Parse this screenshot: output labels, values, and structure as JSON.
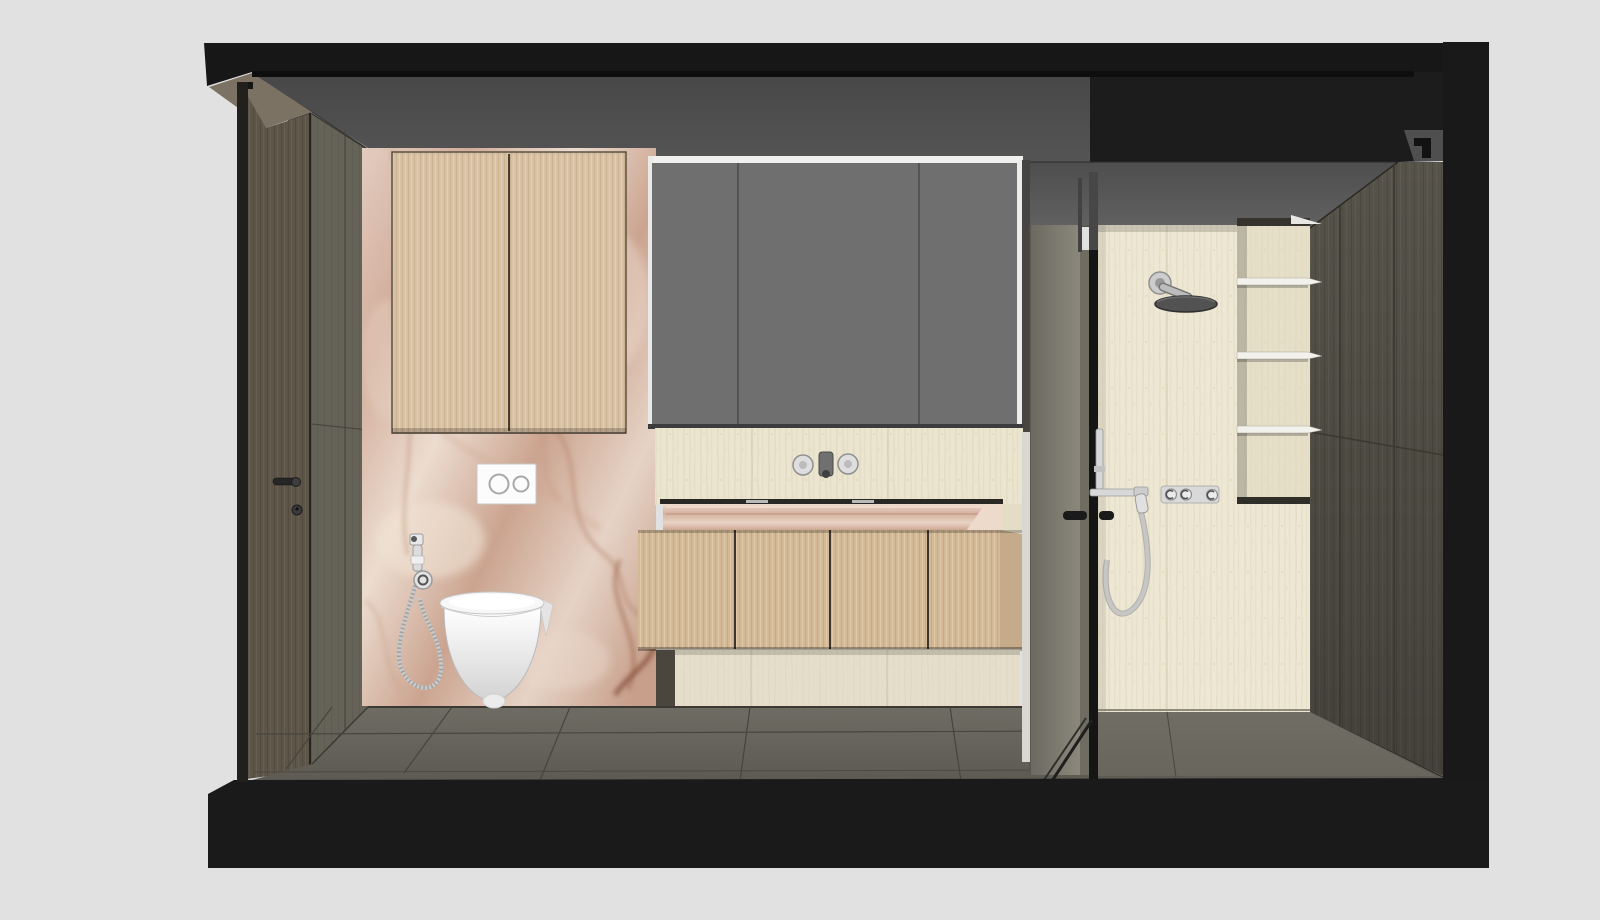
{
  "scene": {
    "description": "3D cutaway section render of a modern bathroom interior, flat-shaded CAD style, no visible text or UI chrome",
    "view": "front section perspective looking into the room",
    "background_color": "#e1e1e1"
  },
  "palette": {
    "background": "#e1e1e1",
    "frame-black": "#171717",
    "soffit-black": "#1c1c1c",
    "ceiling-gray": "#525252",
    "mirror-gray": "#6f6f6f",
    "trim-white": "#f0f0ef",
    "door-brown": "#5e5549",
    "side-wall": "#656258",
    "onyx-base": "#d9bcab",
    "onyx-vein": "#a6755c",
    "wood-light": "#d7c2a5",
    "wood-drawer": "#d3b996",
    "travertine": "#ebe4cf",
    "travertine-shower": "#ede7d3",
    "plinth": "#e5decb",
    "counter-onyx": "#ddbda9",
    "floor-gray": "#67655c",
    "pillar-gray": "#7e7b6f",
    "dark-wood": "#56534a",
    "glass-frame": "#151515",
    "chrome": "#d3d3d3",
    "porcelain": "#ffffff",
    "shelf-white": "#f2f1ec"
  },
  "objects": {
    "shell": {
      "label": "black section-cut shell (ceiling slab, floor slab, side walls)"
    },
    "ceiling": {
      "label": "gray ceiling plane"
    },
    "soffit": {
      "label": "dropped ceiling soffit over shower"
    },
    "entry_door": {
      "label": "dark wood entry door with lever handle and lock"
    },
    "side_wall": {
      "label": "gray-brown paneled wall beside door"
    },
    "onyx_wall": {
      "label": "pink onyx marble feature wall behind toilet"
    },
    "wall_cabinet": {
      "label": "two-door light oak wall cabinet",
      "door_count": 2
    },
    "flush_plate": {
      "label": "white dual-flush plate with two round buttons",
      "button_count": 2
    },
    "bidet_sprayer": {
      "label": "chrome bidet hand sprayer with coiled hose on wall holder"
    },
    "toilet": {
      "label": "white wall-hung toilet"
    },
    "mirror_cabinet": {
      "label": "gray three-door mirror cabinet above vanity",
      "door_count": 3
    },
    "backsplash": {
      "label": "travertine vanity back wall"
    },
    "faucet": {
      "label": "wall-mounted basin mixer with two round handles and center spout"
    },
    "countertop": {
      "label": "pink onyx counter slab with slot sink"
    },
    "drawers": {
      "label": "light oak vanity with four drawer fronts",
      "front_count": 4
    },
    "plinth": {
      "label": "travertine vanity base"
    },
    "floor": {
      "label": "gray-brown plank floor"
    },
    "pillar": {
      "label": "gray partition wall between vanity and shower"
    },
    "glass_partition": {
      "label": "framed shower glass door with black pulls",
      "handle_count": 2
    },
    "shower_wall": {
      "label": "travertine shower back wall"
    },
    "rain_head": {
      "label": "round rain shower head on wall arm"
    },
    "hand_shower": {
      "label": "hand shower on bar with hanging hose"
    },
    "controls": {
      "label": "chrome thermostatic plate with three knobs",
      "knob_count": 3
    },
    "niche": {
      "label": "shower niche with three white shelves",
      "shelf_count": 3
    },
    "wardrobe": {
      "label": "dark wood wardrobe paneling on right wall"
    }
  }
}
